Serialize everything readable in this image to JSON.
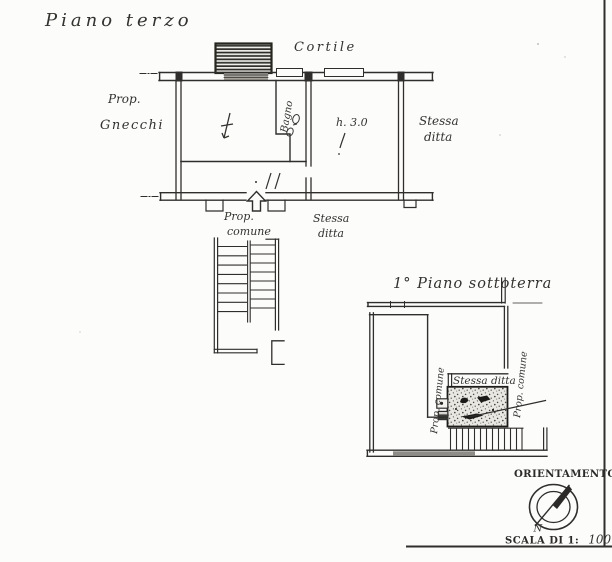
{
  "titles": {
    "upper": "Piano terzo",
    "lower": "1° Piano sottoterra"
  },
  "upper_plan": {
    "cortile": "Cortile",
    "owner_left": {
      "line1": "Prop.",
      "line2": "Gnecchi"
    },
    "bagno": "Bagno",
    "room_height": "h. 3.0",
    "neighbor_right": {
      "line1": "Stessa",
      "line2": "ditta"
    },
    "below_left": {
      "line1": "Prop.",
      "line2": "comune"
    },
    "below_right": {
      "line1": "Stessa",
      "line2": "ditta"
    }
  },
  "lower_plan": {
    "stessa_ditta": "Stessa ditta",
    "prop_comune_left": "Prop. comune",
    "prop_comune_right": "Prop. comune"
  },
  "compass": {
    "title": "ORIENTAMENTO",
    "north": "N",
    "scale_prefix": "SCALA DI 1:",
    "scale_value": "100"
  }
}
